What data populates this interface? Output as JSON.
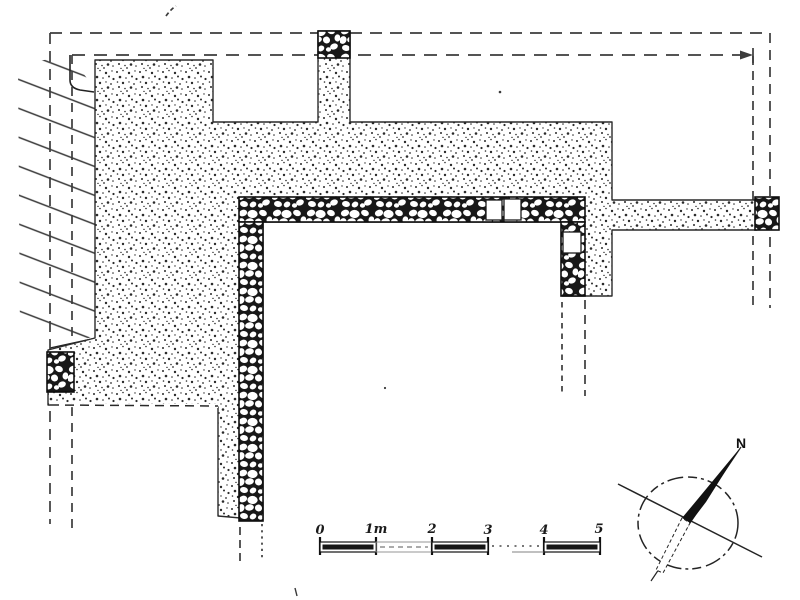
{
  "document": {
    "kind": "hand-drawn archaeological excavation plan (scanned line drawing)",
    "ink_color": "#1d1d1d",
    "paper_color": "#ffffff"
  },
  "scale_bar": {
    "labels": [
      "0",
      "1m",
      "2",
      "3",
      "4",
      "5"
    ],
    "unit": "m",
    "total_meters": 5
  },
  "compass": {
    "north_label": "N"
  },
  "features": {
    "stone_walls": "rubble/cobble masonry walls forming a corner room with door blocks",
    "stippled_area": "excavated platform / wall core rendered as stipple",
    "hatched_area": "diagonal-hatched baulk at west edge",
    "dashed_lines": "excavation limit / reconstruction lines"
  }
}
